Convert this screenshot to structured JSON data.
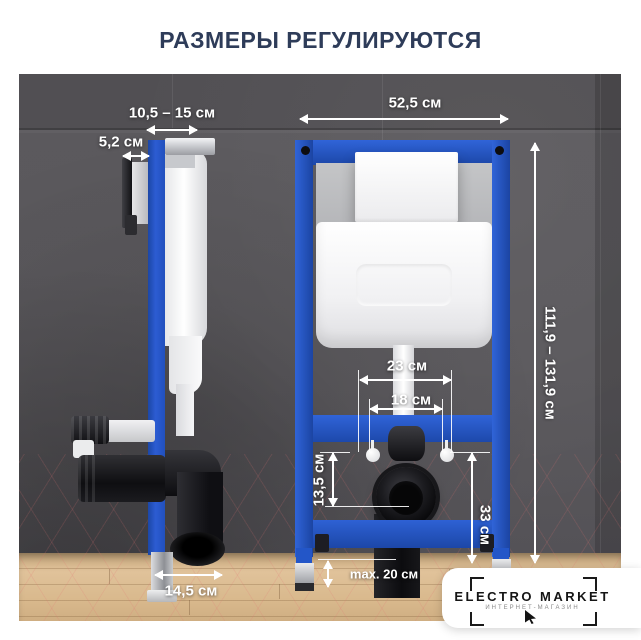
{
  "title": "РАЗМЕРЫ РЕГУЛИРУЮТСЯ",
  "dimensions": {
    "depth_range": "10,5 – 15 см",
    "plate_depth": "5,2 см",
    "frame_width": "52,5 см",
    "frame_height_range": "111,9 – 131,9 см",
    "span_outer": "23 см",
    "span_inner": "18 см",
    "outlet_drop": "13,5 см",
    "outlet_height": "33 см",
    "base_depth": "14,5 см",
    "legs_max": "max. 20 см"
  },
  "brand": {
    "name": "ELECTRO MARKET",
    "tagline": "ИНТЕРНЕТ-МАГАЗИН"
  },
  "colors": {
    "title_navy": "#2e3c59",
    "frame_blue": "#2356c8",
    "wall_gray": "#5a585c",
    "floor_wood": "#d9b98d",
    "annotation_white": "#ffffff"
  }
}
